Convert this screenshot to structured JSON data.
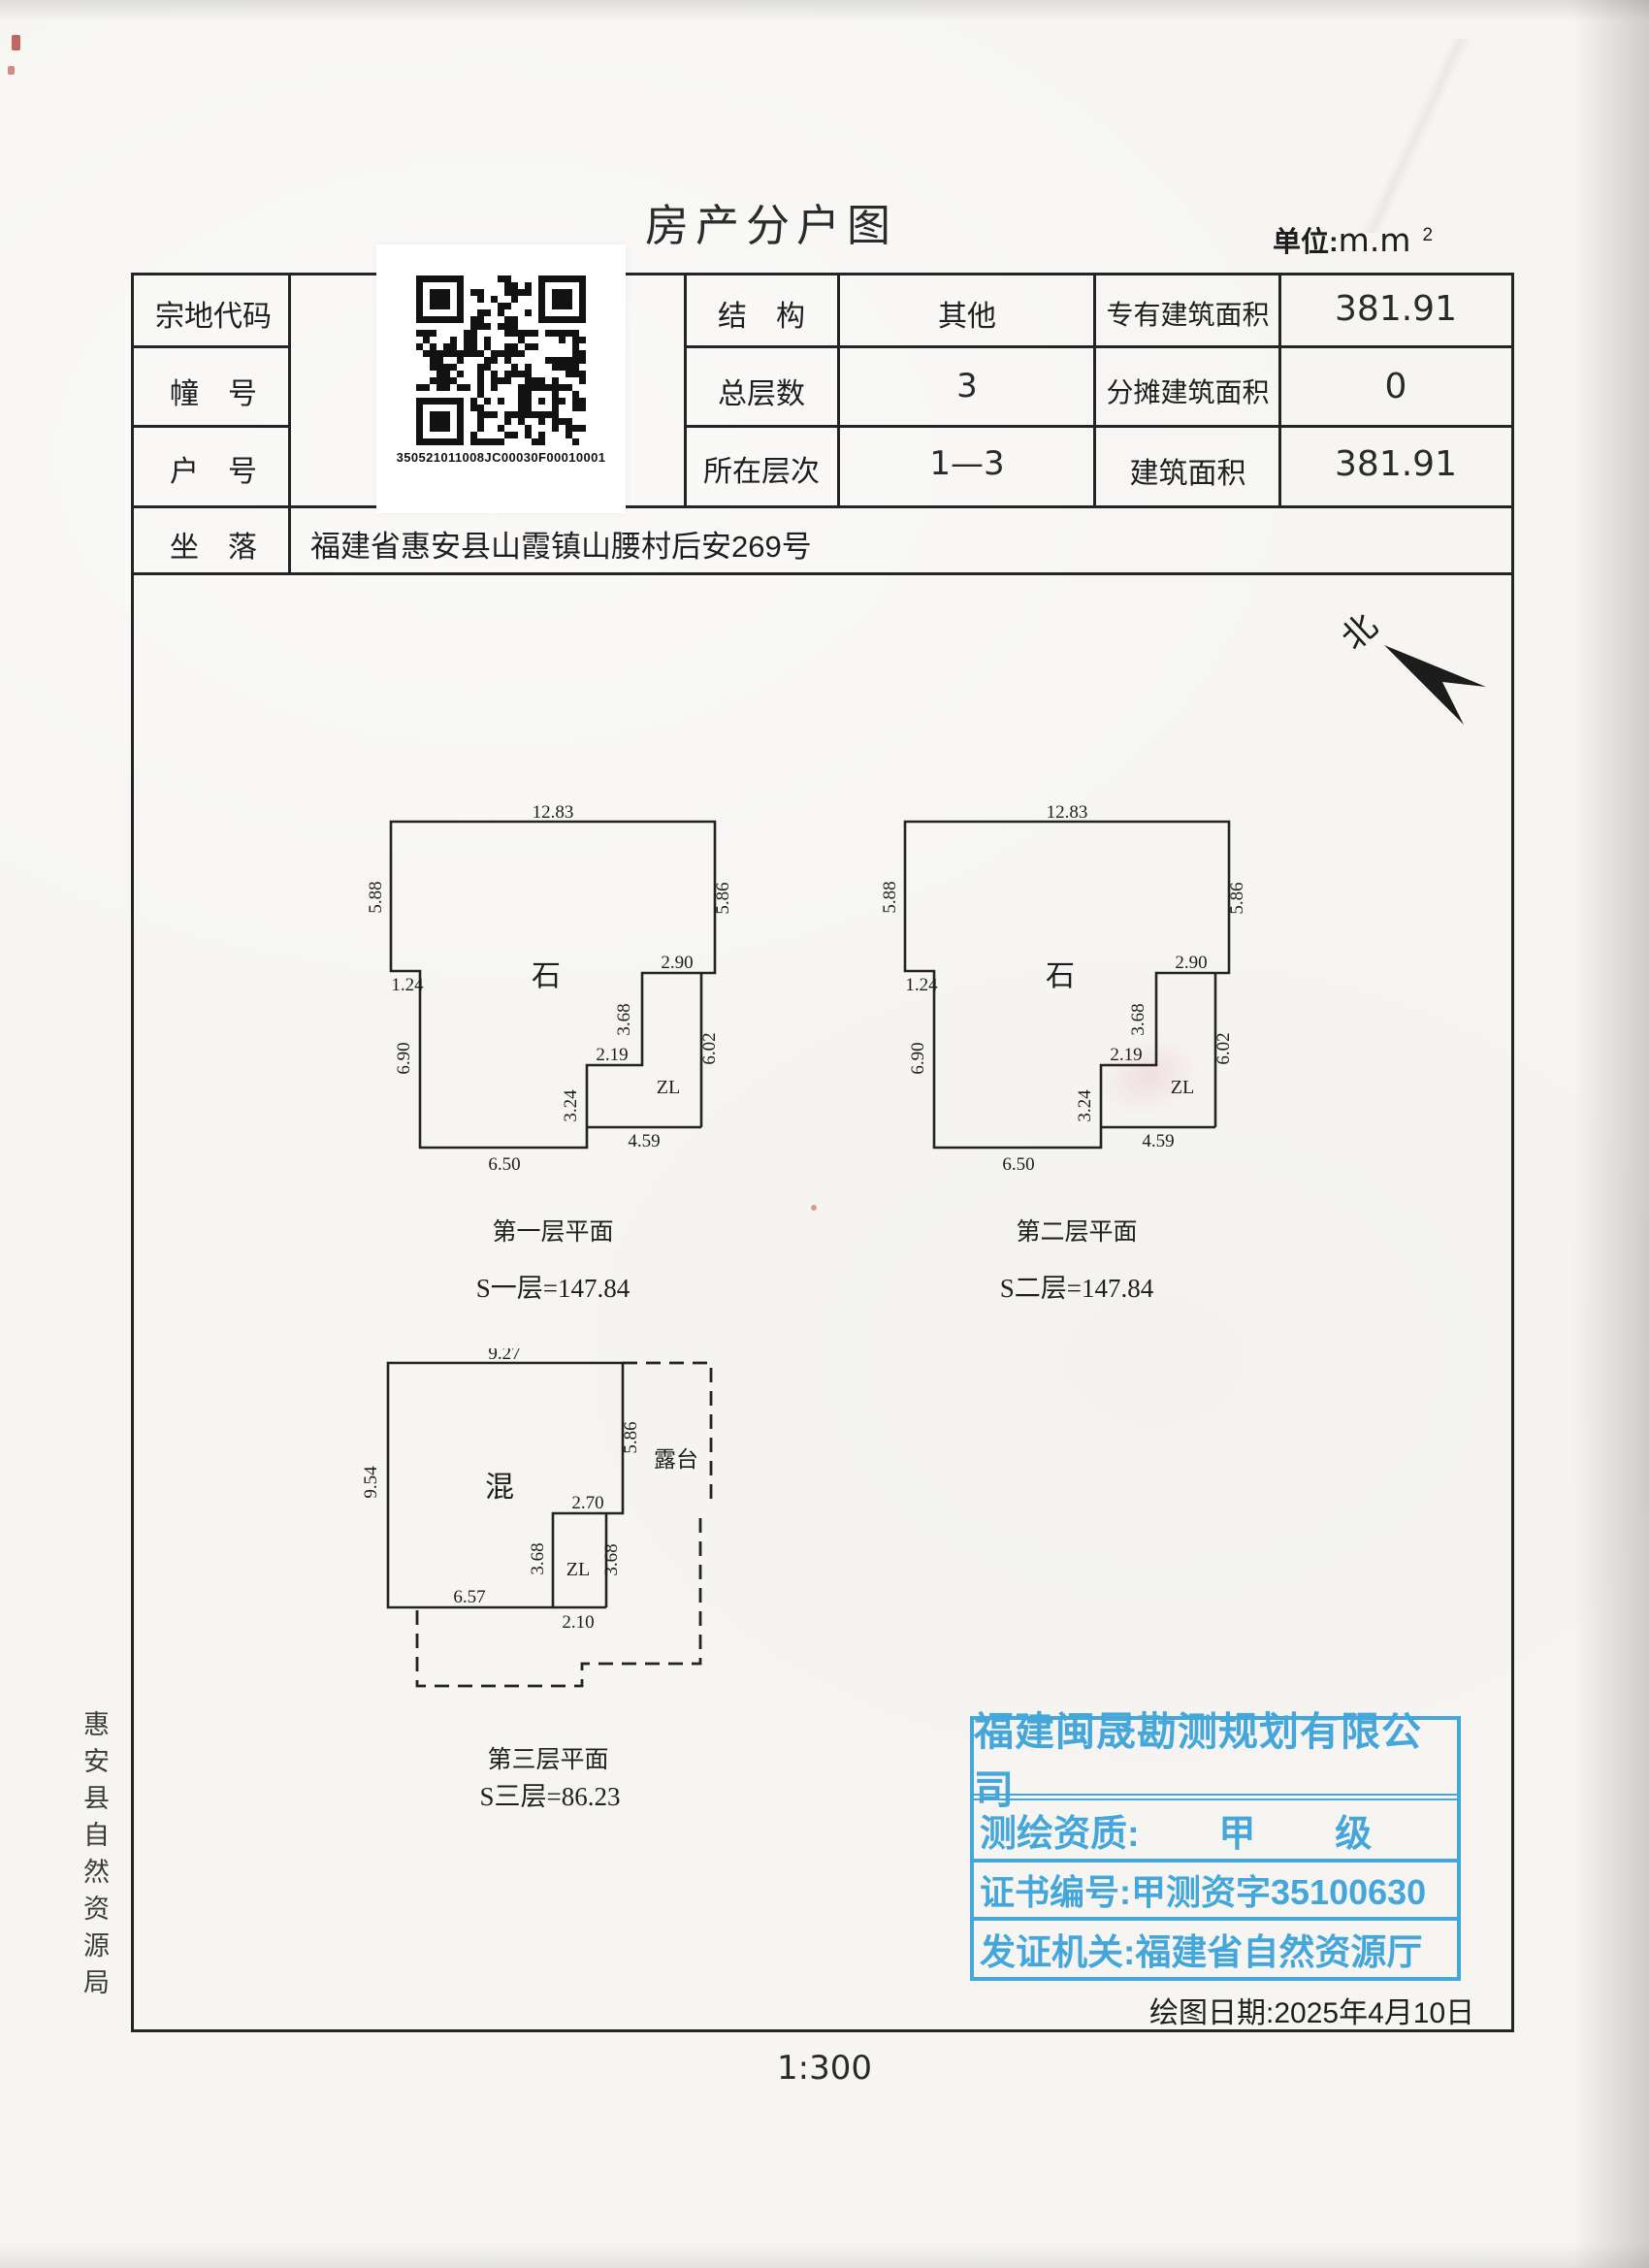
{
  "doc": {
    "title": "房产分户图",
    "unit_label": "单位:",
    "unit_value": "m.m",
    "unit_sup": "2",
    "scale": "1:300",
    "draw_date": "绘图日期:2025年4月10日",
    "margin_agency": "惠安县自然资源局",
    "north": "北"
  },
  "table": {
    "parcel_label": "宗地代码",
    "building_label": "幢　号",
    "household_label": "户　号",
    "location_label": "坐　落",
    "location_value": "福建省惠安县山霞镇山腰村后安269号",
    "qr_number": "350521011008JC00030F00010001",
    "structure_label": "结　构",
    "structure_value": "其他",
    "total_floors_label": "总层数",
    "total_floors_value": "3",
    "floor_level_label": "所在层次",
    "floor_level_value": "1—3",
    "exclusive_area_label": "专有建筑面积",
    "exclusive_area_value": "381.91",
    "shared_area_label": "分摊建筑面积",
    "shared_area_value": "0",
    "building_area_label": "建筑面积",
    "building_area_value": "381.91"
  },
  "plans": [
    {
      "caption": "第一层平面",
      "area_formula": "S一层=147.84",
      "material": "石",
      "zl": "ZL",
      "dims": {
        "top": "12.83",
        "left_upper": "5.88",
        "right_upper": "5.86",
        "zl_top": "2.90",
        "notch": "1.24",
        "left_lower": "6.90",
        "zl_left": "3.68",
        "zl_right": "6.02",
        "step_top": "2.19",
        "step_left": "3.24",
        "zl_bottom": "4.59",
        "bottom": "6.50"
      }
    },
    {
      "caption": "第二层平面",
      "area_formula": "S二层=147.84",
      "material": "石",
      "zl": "ZL",
      "dims": {
        "top": "12.83",
        "left_upper": "5.88",
        "right_upper": "5.86",
        "zl_top": "2.90",
        "notch": "1.24",
        "left_lower": "6.90",
        "zl_left": "3.68",
        "zl_right": "6.02",
        "step_top": "2.19",
        "step_left": "3.24",
        "zl_bottom": "4.59",
        "bottom": "6.50"
      }
    },
    {
      "caption": "第三层平面",
      "area_formula": "S三层=86.23",
      "material": "混",
      "zl": "ZL",
      "terrace": "露台",
      "dims": {
        "top": "9.27",
        "left": "9.54",
        "right": "5.86",
        "zl_top": "2.70",
        "zl_left": "3.68",
        "zl_right": "3.68",
        "bottom": "6.57",
        "zl_bottom": "2.10"
      }
    }
  ],
  "stamp": {
    "company": "福建闽晟勘测规划有限公司",
    "qualification_label": "测绘资质:",
    "qualification_value_1": "甲",
    "qualification_value_2": "级",
    "certificate_label": "证书编号:",
    "certificate_value": "甲测资字35100630",
    "authority_label": "发证机关:",
    "authority_value": "福建省自然资源厅",
    "color": "#38a2d8"
  }
}
